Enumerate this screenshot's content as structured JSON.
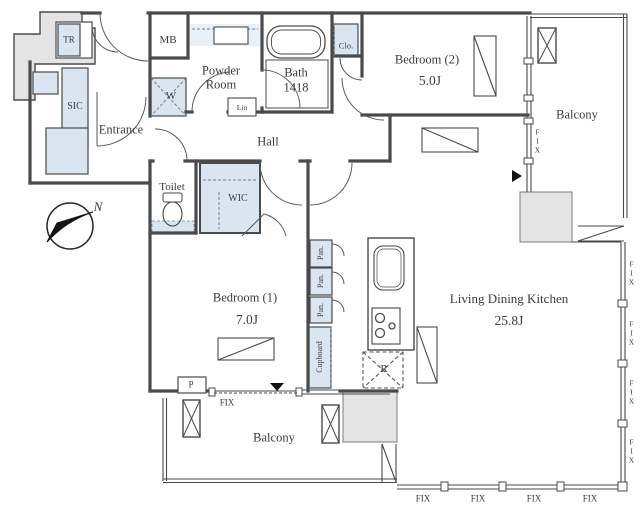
{
  "plan": {
    "rooms": {
      "entrance": "Entrance",
      "hall": "Hall",
      "toilet": "Toilet",
      "powder_line1": "Powder",
      "powder_line2": "Room",
      "bath": "Bath",
      "bath_size": "1418",
      "bedroom2": "Bedroom (2)",
      "bedroom2_size": "5.0J",
      "bedroom1": "Bedroom (1)",
      "bedroom1_size": "7.0J",
      "ldk": "Living Dining Kitchen",
      "ldk_size": "25.8J",
      "balcony_right": "Balcony",
      "balcony_bottom": "Balcony"
    },
    "storage": {
      "tr": "TR",
      "mb": "MB",
      "sic": "SIC",
      "washer": "W",
      "linen": "Lin",
      "closet": "Clo.",
      "wic": "WIC",
      "pantry": [
        "Pan.",
        "Pan.",
        "Pan."
      ],
      "cupboard": "Cupboard",
      "fridge": "R",
      "pipe_space": "P"
    },
    "windows": {
      "fix_balcony_right": "FIX",
      "fix_bedroom1": "FIX",
      "fix_bottom": [
        "FIX",
        "FIX",
        "FIX",
        "FIX"
      ],
      "fix_right": [
        "FIX",
        "FIX",
        "FIX",
        "FIX"
      ]
    },
    "compass": {
      "north": "N"
    },
    "colors": {
      "wall": "#4a4a4a",
      "storage_fill": "#d9e6f2",
      "outside_fill": "#e4e4e4",
      "thin_line": "#6b6b6b"
    }
  }
}
